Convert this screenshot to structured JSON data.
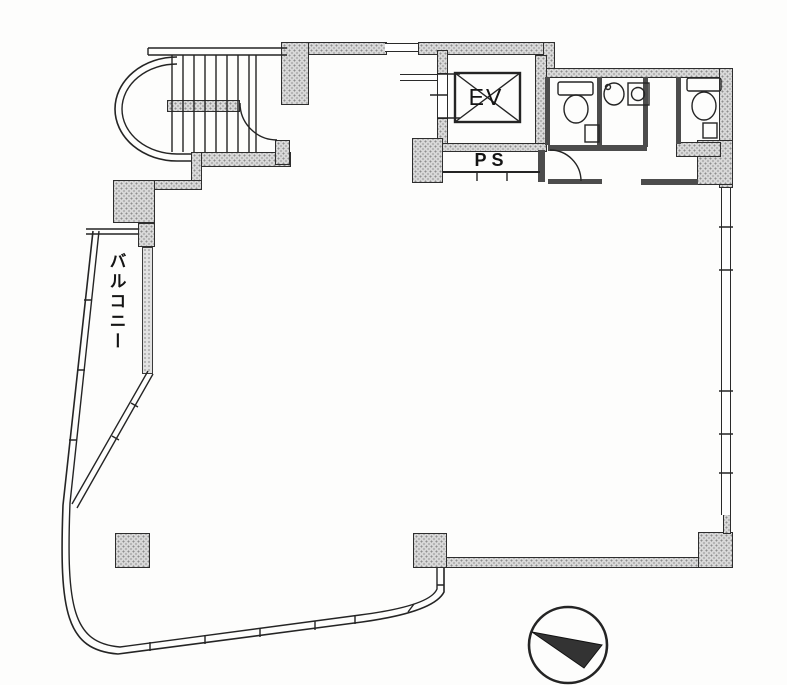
{
  "labels": {
    "elevator": "EV",
    "pipe_space": "PS",
    "balcony": "バルコニー"
  },
  "colors": {
    "background": "#fdfdfc",
    "wall_fill": "#d8d8d8",
    "wall_outline": "#2e2e2e",
    "linework": "#242424",
    "north_arrow_fill": "#333333"
  },
  "icons": {
    "north-arrow-icon": "circle with filled triangle",
    "elevator-car-icon": "square crossed with X",
    "toilet-icon": "tank with oval bowl",
    "sink-icon": "round basin with tap",
    "washer-icon": "square with inner circle",
    "door-arc-icon": "quarter-circle door swing",
    "staircase-icon": "parallel treads with curved end"
  }
}
